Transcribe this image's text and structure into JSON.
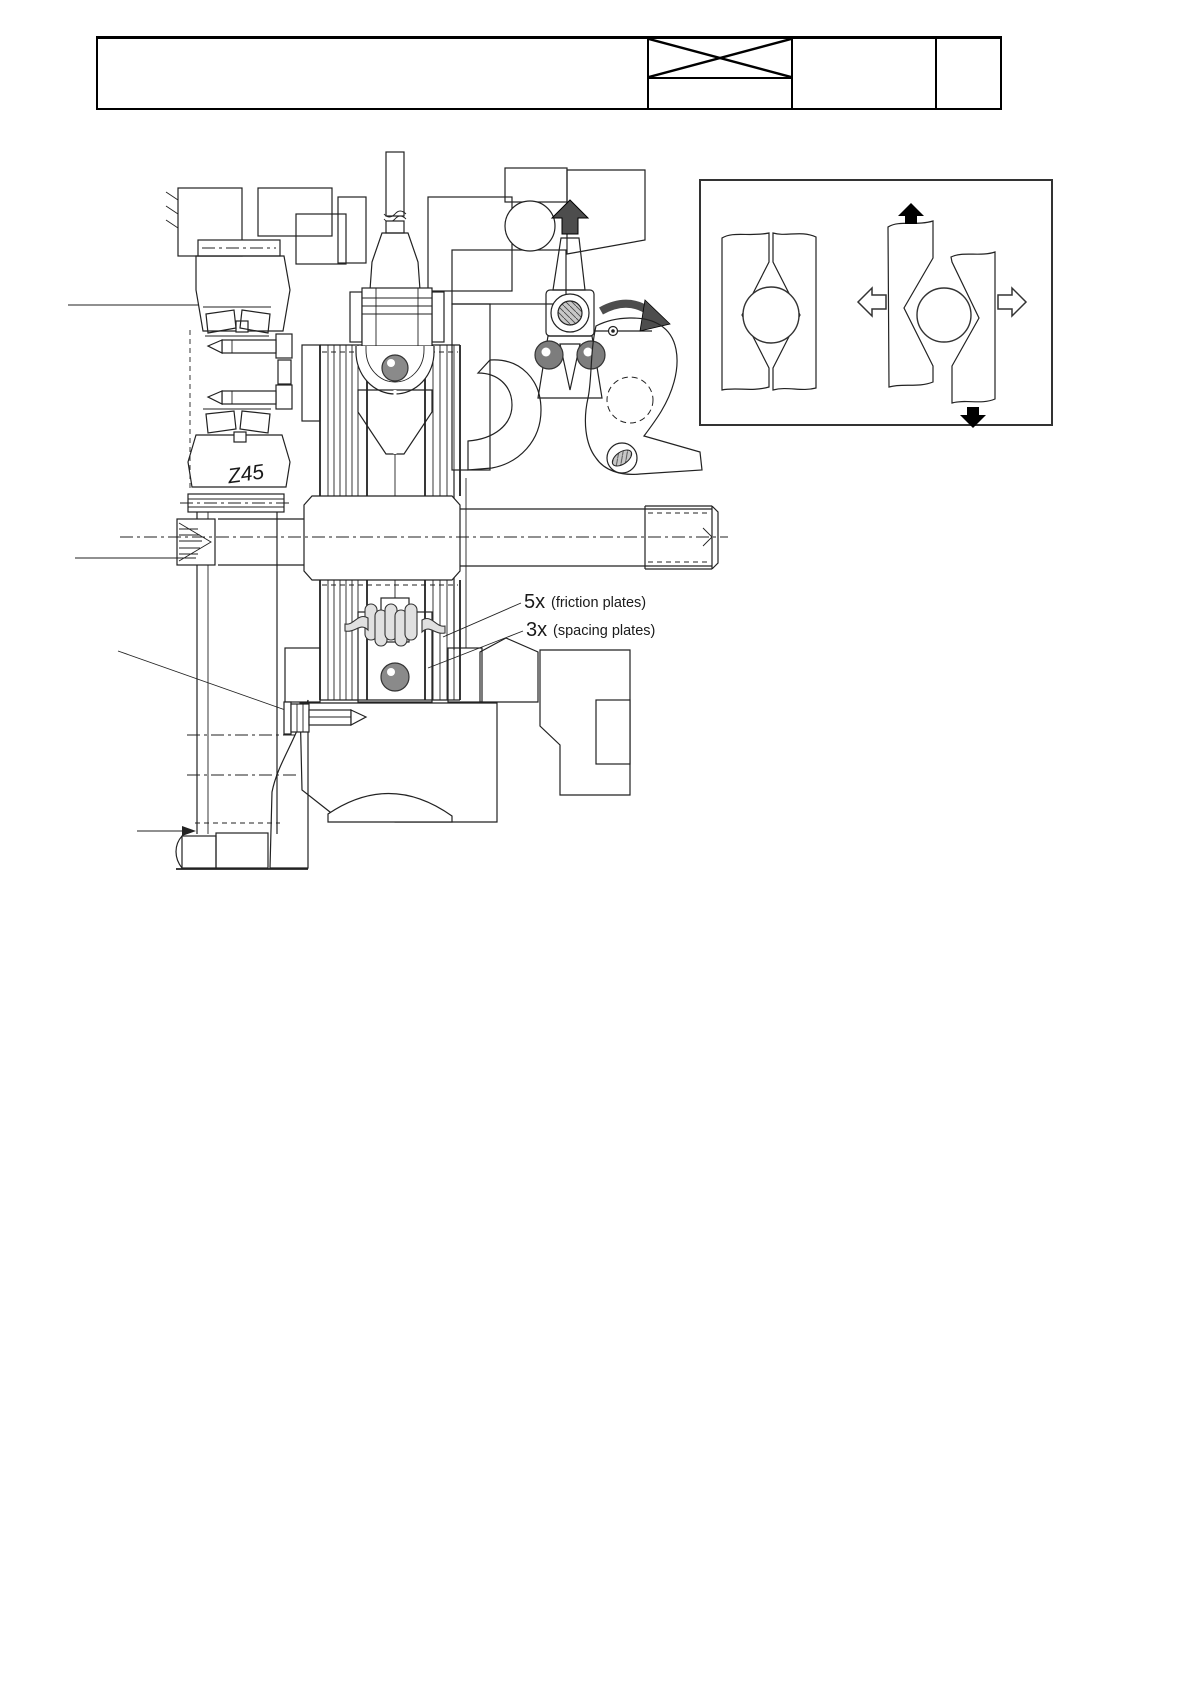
{
  "page": {
    "width": 1190,
    "height": 1684,
    "background": "#ffffff",
    "ink": "#222222"
  },
  "header": {
    "cells": [
      {
        "label": ""
      },
      {
        "label": "",
        "crossed": true
      },
      {
        "label": ""
      },
      {
        "label": ""
      }
    ]
  },
  "drawing": {
    "gear_label": "Z45",
    "callouts": [
      {
        "qty": "5x",
        "label": "(friction plates)"
      },
      {
        "qty": "3x",
        "label": "(spacing plates)"
      }
    ],
    "detail_view": {
      "icons": [
        "up-arrow-icon",
        "rotation-arrow-icon"
      ]
    },
    "inset_view": {
      "icons": [
        "up-arrow-icon",
        "down-arrow-icon",
        "left-arrow-icon",
        "right-arrow-icon"
      ]
    },
    "colors": {
      "ball_gray": "#8a8a8a",
      "roller_gray": "#7d7d7d",
      "bearing_gray": "#a0a0a0",
      "arrow_dark": "#4d4d4d",
      "part_gray": "#c8c8c8",
      "cam_gray": "#ececec"
    }
  }
}
